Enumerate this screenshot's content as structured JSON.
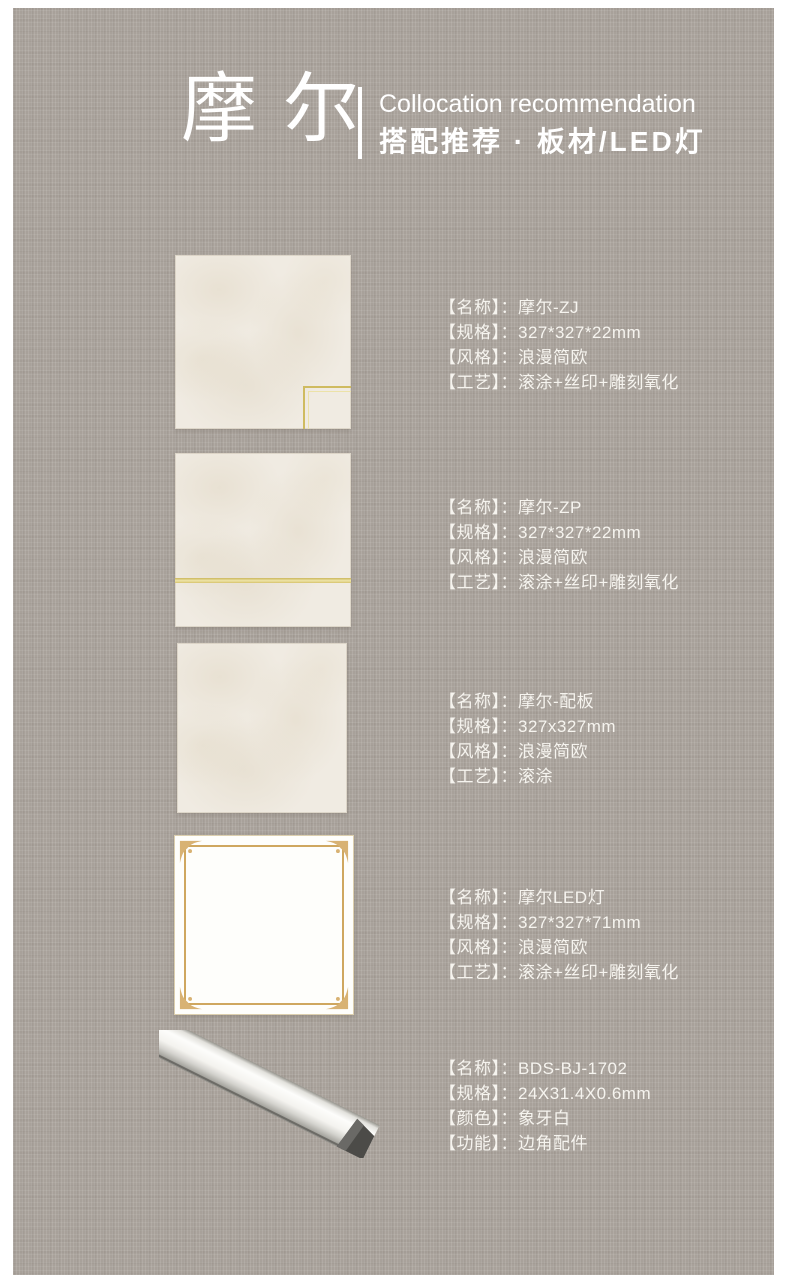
{
  "colors": {
    "canvas_background": "#a8a19a",
    "page_border": "#ffffff",
    "text_white": "#f6f4ef",
    "gold_accent": "#cfbb60",
    "led_frame_gold": "#cfa75f",
    "tile_cream": "#f0ebe2"
  },
  "header": {
    "brand": "摩尔",
    "title_en": "Collocation recommendation",
    "title_zh": "搭配推荐 · 板材/LED灯"
  },
  "products": [
    {
      "image_name": "tile-with-gold-corner-accent",
      "specs": [
        {
          "label": "【名称】：",
          "value": "摩尔-ZJ"
        },
        {
          "label": "【规格】：",
          "value": "327*327*22mm"
        },
        {
          "label": "【风格】：",
          "value": "浪漫简欧"
        },
        {
          "label": "【工艺】：",
          "value": "滚涂+丝印+雕刻氧化"
        }
      ]
    },
    {
      "image_name": "tile-with-gold-horizontal-line",
      "specs": [
        {
          "label": "【名称】：",
          "value": "摩尔-ZP"
        },
        {
          "label": "【规格】：",
          "value": "327*327*22mm"
        },
        {
          "label": "【风格】：",
          "value": "浪漫简欧"
        },
        {
          "label": "【工艺】：",
          "value": "滚涂+丝印+雕刻氧化"
        }
      ]
    },
    {
      "image_name": "plain-cream-tile",
      "specs": [
        {
          "label": "【名称】：",
          "value": "摩尔-配板"
        },
        {
          "label": "【规格】：",
          "value": "327x327mm"
        },
        {
          "label": "【风格】：",
          "value": "浪漫简欧"
        },
        {
          "label": "【工艺】：",
          "value": "滚涂"
        }
      ]
    },
    {
      "image_name": "led-light-panel-with-gold-frame",
      "specs": [
        {
          "label": "【名称】：",
          "value": "摩尔LED灯"
        },
        {
          "label": "【规格】：",
          "value": "327*327*71mm"
        },
        {
          "label": "【风格】：",
          "value": "浪漫简欧"
        },
        {
          "label": "【工艺】：",
          "value": "滚涂+丝印+雕刻氧化"
        }
      ]
    },
    {
      "image_name": "ivory-corner-trim-strip",
      "specs": [
        {
          "label": "【名称】：",
          "value": "BDS-BJ-1702"
        },
        {
          "label": "【规格】：",
          "value": "24X31.4X0.6mm"
        },
        {
          "label": "【颜色】：",
          "value": "象牙白"
        },
        {
          "label": "【功能】：",
          "value": "边角配件"
        }
      ]
    }
  ]
}
